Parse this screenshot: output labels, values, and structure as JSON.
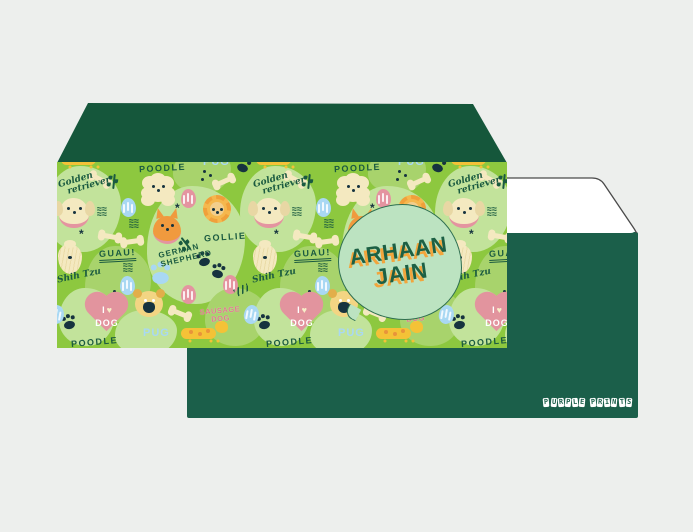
{
  "page": {
    "background": "#EDEFED",
    "description": "personalized dog-themed money envelope mockup"
  },
  "front_envelope": {
    "name_badge": {
      "line1": "ARHAAN",
      "line2": "JAIN",
      "text_color": "#1D6044",
      "shadow_color": "#F2A53C",
      "badge_color": "#BCE3C1"
    },
    "colors": {
      "flap": "#15573B",
      "pattern_bg": "#8DC83F",
      "blob_light": "#C2E39B",
      "blob_mid": "#A8D36C",
      "cream": "#F4E9C0",
      "orange": "#F09A3E",
      "yellow": "#F4C237",
      "pink": "#E494A0",
      "blue": "#A9D8F3",
      "ink": "#1A5A40",
      "ink_dark": "#16333F"
    },
    "pattern_labels": {
      "golden": [
        "Golden",
        "retriever"
      ],
      "poodle": [
        "POODLE"
      ],
      "german": [
        "GERMAN",
        "SHEPHERD"
      ],
      "collie": [
        "GOLLIE"
      ],
      "guau": [
        "GUAU!"
      ],
      "shihtzu": [
        "Shih Tzu"
      ],
      "sausage": [
        "SAUSAGE",
        "DOG"
      ],
      "pug": [
        "PUG"
      ],
      "poodle_bottom": [
        "POODLE"
      ],
      "love": {
        "i": "I",
        "heart": "♥",
        "dog": "DOG"
      }
    },
    "tile": {
      "width": 195,
      "repeats": 3,
      "items": [
        {
          "t": "blob",
          "c": "light",
          "x": -12,
          "y": 4,
          "w": 76,
          "h": 86
        },
        {
          "t": "blob",
          "c": "mid",
          "x": 116,
          "y": -14,
          "w": 58,
          "h": 46
        },
        {
          "t": "blob",
          "c": "light",
          "x": 90,
          "y": 24,
          "w": 98,
          "h": 118
        },
        {
          "t": "blob",
          "c": "mid",
          "x": 28,
          "y": 84,
          "w": 66,
          "h": 76
        },
        {
          "t": "blob",
          "c": "light",
          "x": 2,
          "y": 126,
          "w": 56,
          "h": 58
        },
        {
          "t": "blob",
          "c": "mid",
          "x": 148,
          "y": 126,
          "w": 62,
          "h": 58
        },
        {
          "t": "blob",
          "c": "light",
          "x": 58,
          "y": 148,
          "w": 62,
          "h": 46
        },
        {
          "t": "dog-sausage",
          "x": 4,
          "y": -16
        },
        {
          "t": "pug-txt",
          "k": "pug",
          "x": 146,
          "y": -6
        },
        {
          "t": "paw",
          "c": "dark",
          "x": 180,
          "y": 2,
          "r": 20
        },
        {
          "t": "cursive",
          "k": "golden",
          "x": 2,
          "y": 12,
          "r": -16
        },
        {
          "t": "bone",
          "x": 34,
          "y": 15,
          "r": 28
        },
        {
          "t": "sprig",
          "x": 56,
          "y": 12,
          "r": 6
        },
        {
          "t": "hand",
          "k": "poodle",
          "x": 82,
          "y": 1,
          "r": -3
        },
        {
          "t": "dog-poodle",
          "x": 88,
          "y": 16
        },
        {
          "t": "dots",
          "x": 146,
          "y": 8
        },
        {
          "t": "bone",
          "x": 158,
          "y": 17,
          "r": -24
        },
        {
          "t": "coral",
          "c": "pink",
          "x": 124,
          "y": 27
        },
        {
          "t": "star",
          "x": 118,
          "y": 42
        },
        {
          "t": "dog-golden",
          "x": 2,
          "y": 36
        },
        {
          "t": "waves",
          "x": 40,
          "y": 45
        },
        {
          "t": "coral",
          "c": "blue",
          "x": 64,
          "y": 36
        },
        {
          "t": "dog-collie",
          "x": 146,
          "y": 33
        },
        {
          "t": "hand",
          "k": "collie",
          "x": 147,
          "y": 70,
          "r": -4
        },
        {
          "t": "star",
          "x": 22,
          "y": 68
        },
        {
          "t": "dog-shepherd",
          "x": 96,
          "y": 54
        },
        {
          "t": "hand2",
          "k": "german",
          "x": 102,
          "y": 83,
          "r": -13
        },
        {
          "t": "waves",
          "x": 72,
          "y": 57
        },
        {
          "t": "bone",
          "x": 44,
          "y": 72,
          "r": 10
        },
        {
          "t": "bone",
          "x": 66,
          "y": 77,
          "r": -8
        },
        {
          "t": "guau",
          "k": "guau",
          "x": 42,
          "y": 86,
          "r": -3
        },
        {
          "t": "sprig",
          "x": 128,
          "y": 74,
          "r": -38
        },
        {
          "t": "dog-shihtzu",
          "x": 1,
          "y": 82
        },
        {
          "t": "cursive1",
          "k": "shihtzu",
          "x": 0,
          "y": 110,
          "r": -12
        },
        {
          "t": "paw",
          "c": "dark",
          "x": 142,
          "y": 96,
          "r": -14
        },
        {
          "t": "paw",
          "c": "dark",
          "x": 155,
          "y": 108,
          "r": 12
        },
        {
          "t": "waves",
          "x": 66,
          "y": 101
        },
        {
          "t": "coral",
          "c": "blue",
          "x": 63,
          "y": 114
        },
        {
          "t": "paw",
          "c": "blue",
          "x": 98,
          "y": 112,
          "s": 1.5
        },
        {
          "t": "coral",
          "c": "pink",
          "x": 124,
          "y": 123
        },
        {
          "t": "coral",
          "c": "pink",
          "x": 166,
          "y": 113
        },
        {
          "t": "squiggle",
          "x": 177,
          "y": 124,
          "r": -28
        },
        {
          "t": "dots",
          "x": 56,
          "y": 128
        },
        {
          "t": "heart",
          "x": 29,
          "y": 131
        },
        {
          "t": "dog-pug",
          "x": 78,
          "y": 129
        },
        {
          "t": "bone",
          "x": 114,
          "y": 149,
          "r": 22
        },
        {
          "t": "sausage-txt",
          "k": "sausage",
          "x": 143,
          "y": 145,
          "r": -5
        },
        {
          "t": "dog-sausage",
          "x": 124,
          "y": 158
        },
        {
          "t": "pug-txt",
          "k": "pug",
          "x": 86,
          "y": 165
        },
        {
          "t": "hand",
          "k": "poodle_bottom",
          "x": 14,
          "y": 175,
          "r": -5
        },
        {
          "t": "paw",
          "c": "dark",
          "x": 7,
          "y": 159,
          "r": -10
        },
        {
          "t": "coral",
          "c": "blue",
          "x": -8,
          "y": 143,
          "r": 10
        }
      ]
    }
  },
  "back_envelope": {
    "color": "#1B5F4A",
    "brand": "PURPLE PRINTS",
    "flap_fill": "#FFFFFF",
    "flap_outline": "#4A4A4A"
  }
}
